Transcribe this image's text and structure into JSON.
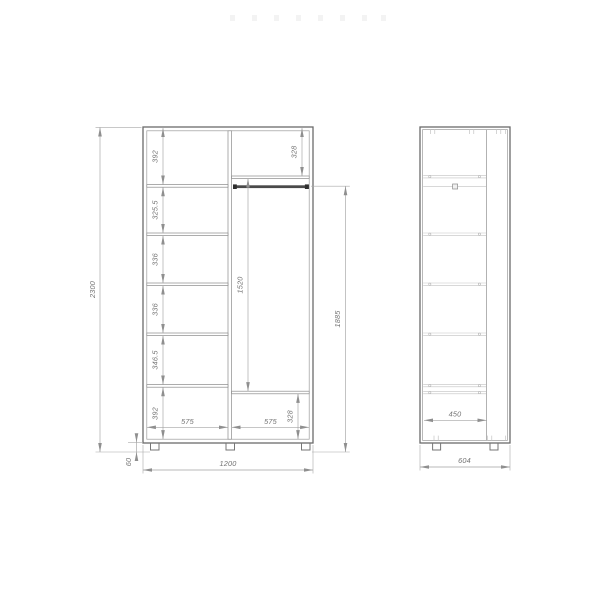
{
  "palette": {
    "panel_line": "#6b6b6b",
    "dimension_line": "#a3a3a3",
    "label_text": "#737373",
    "rod_fill": "#3a3a3a"
  },
  "front_view": {
    "dims": {
      "overall_height": "2300",
      "overall_width": "1200",
      "leg_height": "60",
      "bay_width_left": "575",
      "bay_width_right": "575",
      "top_right_compartment": "328",
      "hanging_space": "1520",
      "rod_to_floor": "1885",
      "bottom_right_compartment": "328",
      "left_compartments": [
        "392",
        "325.5",
        "336",
        "336",
        "346.5",
        "392"
      ]
    }
  },
  "side_view": {
    "dims": {
      "interior_depth": "450",
      "overall_depth": "604"
    }
  }
}
